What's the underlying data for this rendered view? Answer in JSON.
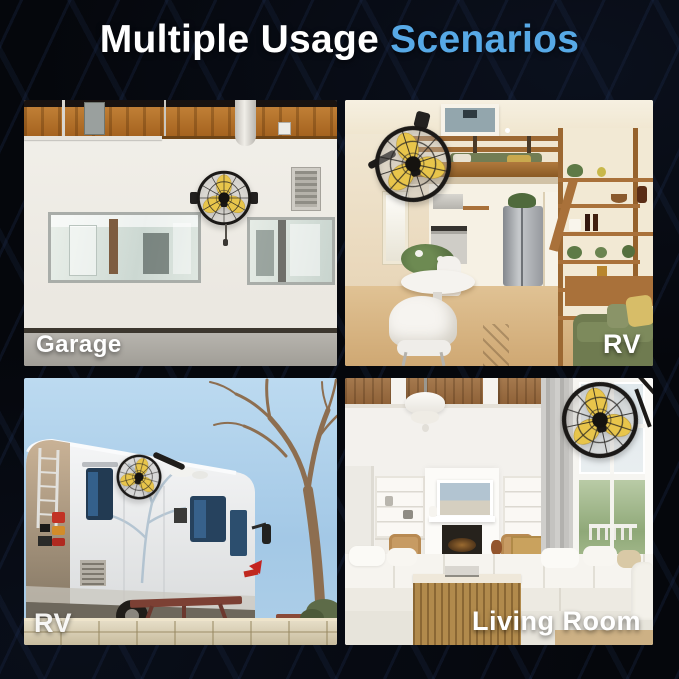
{
  "canvas": {
    "width": 679,
    "height": 679,
    "background": "#05070c"
  },
  "title": {
    "part1": "Multiple Usage",
    "part2": "Scenarios",
    "part1_color": "#ffffff",
    "part2_color": "#57a9e6"
  },
  "fan": {
    "blade_color": "#e8c54b",
    "cage_color": "#1b1917"
  },
  "scenes": [
    {
      "id": "garage",
      "label": "Garage",
      "label_position": "bottom-left"
    },
    {
      "id": "rv-interior",
      "label": "RV",
      "label_position": "bottom-right"
    },
    {
      "id": "rv-exterior",
      "label": "RV",
      "label_position": "bottom-left"
    },
    {
      "id": "living-room",
      "label": "Living Room",
      "label_position": "bottom-right"
    }
  ]
}
